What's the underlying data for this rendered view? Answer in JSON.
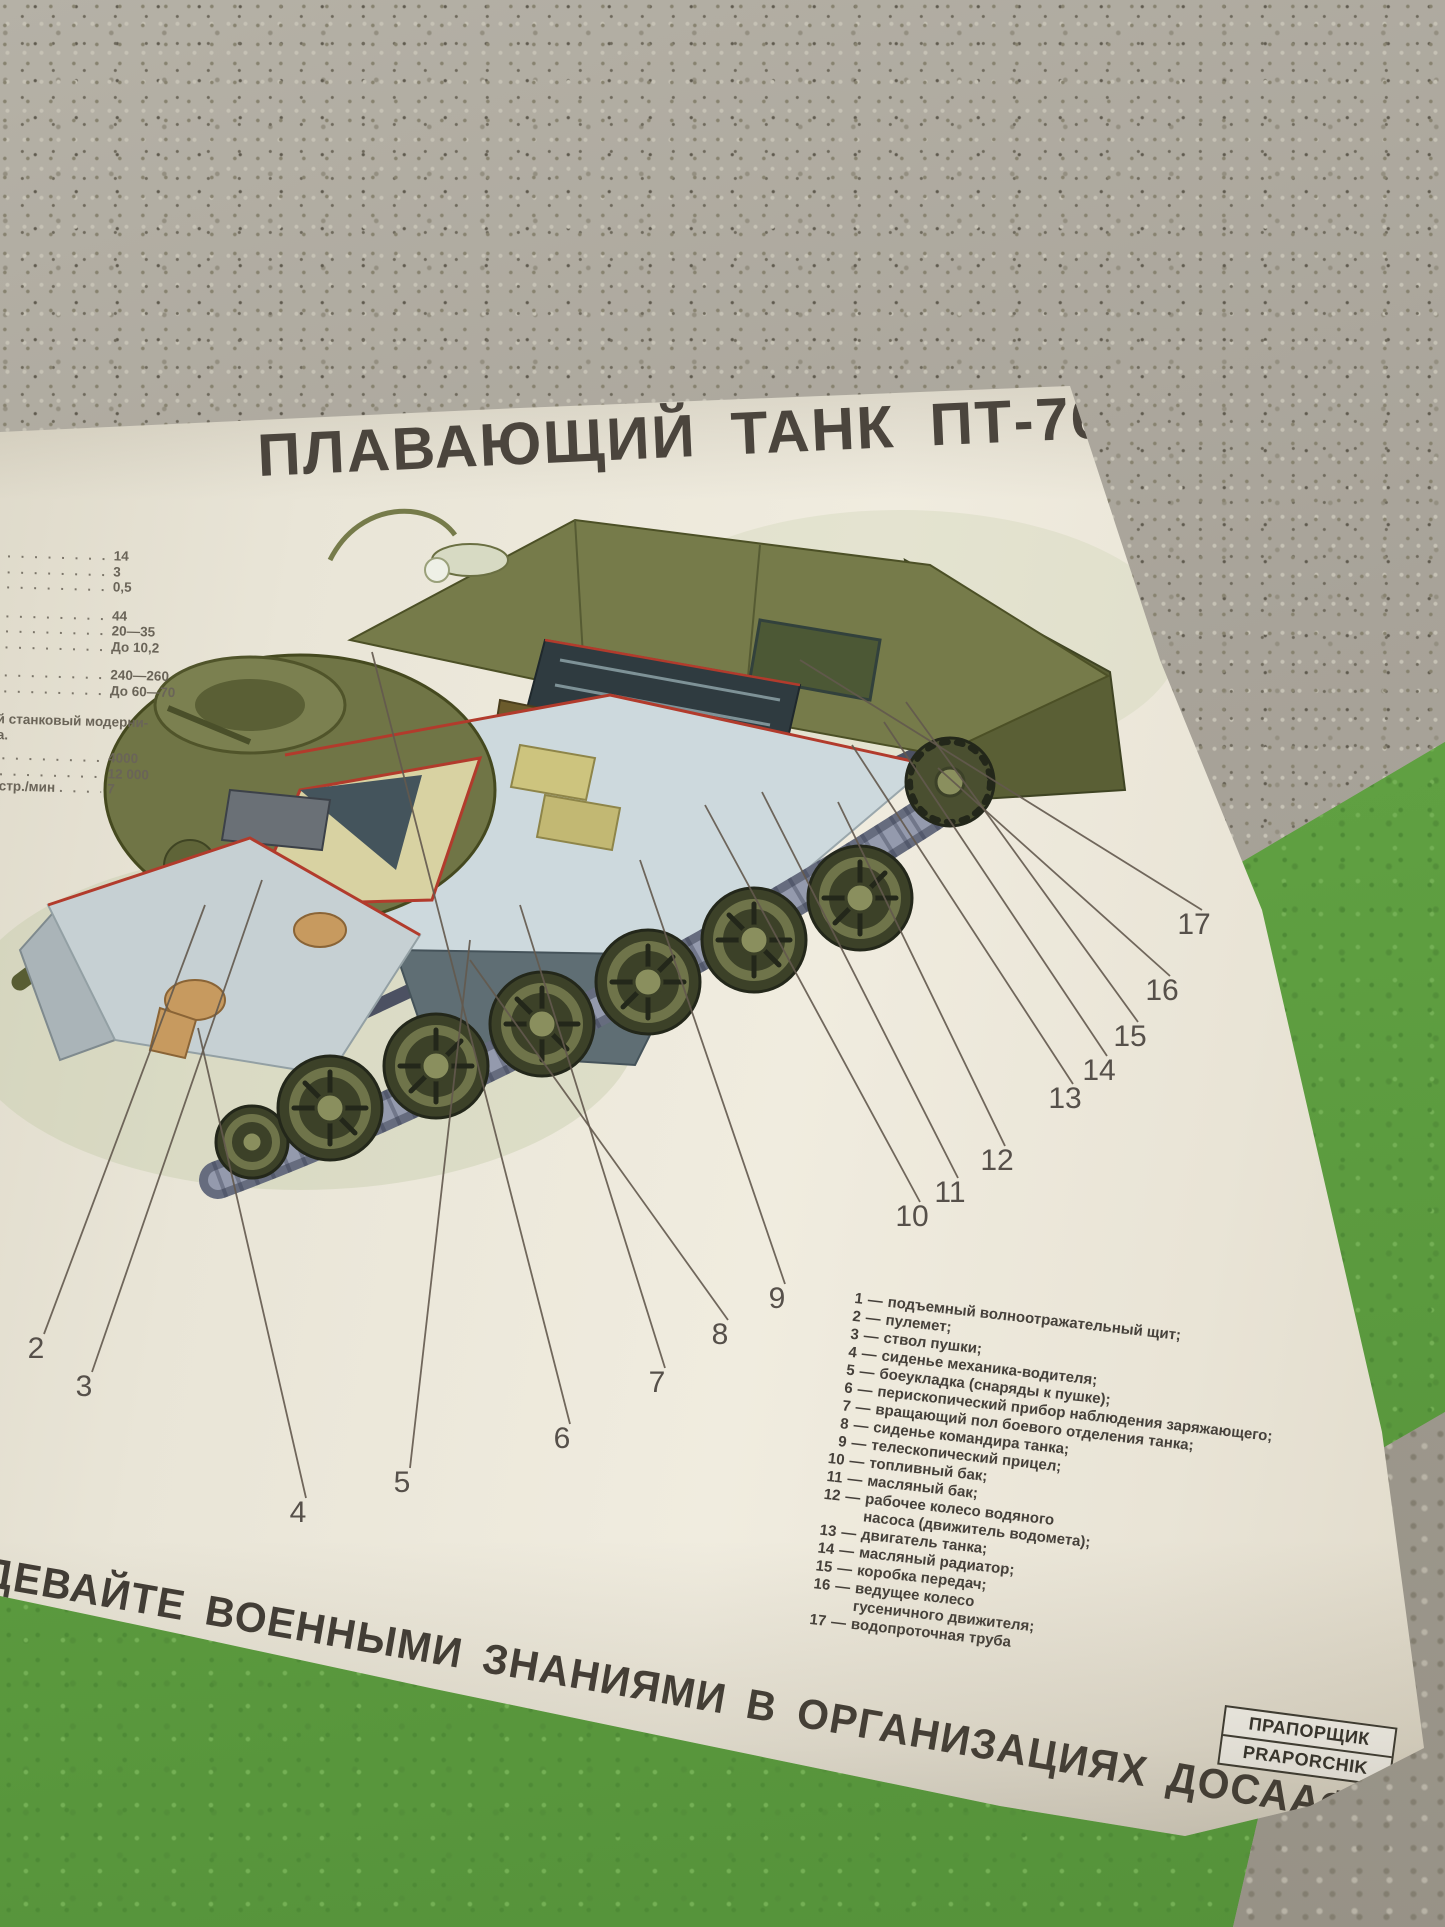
{
  "scene": {
    "wall_top_color": "#aba69c",
    "wall_bottom_color": "#5f9f41",
    "paper_color": "#eae6d9"
  },
  "poster": {
    "title": "ПЛАВАЮЩИЙ ТАНК ПТ-76",
    "title_color": "#4b453d",
    "accent_red": "#b23b2c",
    "tank_olive": "#707546",
    "specs": {
      "entries": [
        {
          "type": "row",
          "fragment": "",
          "value": "14",
          "gap": false
        },
        {
          "type": "row",
          "fragment": "",
          "value": "3",
          "gap": false
        },
        {
          "type": "row",
          "fragment": "",
          "value": "0,5",
          "gap": false
        },
        {
          "type": "row",
          "fragment": "",
          "value": "44",
          "gap": true
        },
        {
          "type": "row",
          "fragment": "",
          "value": "20—35",
          "gap": false
        },
        {
          "type": "row",
          "fragment": "",
          "value": "До 10,2",
          "gap": false
        },
        {
          "type": "row",
          "fragment": "",
          "value": "240—260",
          "gap": true
        },
        {
          "type": "row",
          "fragment": "",
          "value": "До 60—70",
          "gap": false
        },
        {
          "type": "note",
          "lines": [
            "ей станковый модерни-",
            "ва."
          ]
        },
        {
          "type": "row",
          "fragment": "",
          "value": "4000",
          "gap": false
        },
        {
          "type": "row",
          "fragment": "а",
          "value": "12 000",
          "gap": false
        },
        {
          "type": "row",
          "fragment": "ыстр./мин",
          "value": "7",
          "gap": false
        }
      ]
    },
    "legend": {
      "items": [
        {
          "num": "1",
          "text": "подъемный волноотражательный щит;",
          "text2": ""
        },
        {
          "num": "2",
          "text": "пулемет;",
          "text2": ""
        },
        {
          "num": "3",
          "text": "ствол пушки;",
          "text2": ""
        },
        {
          "num": "4",
          "text": "сиденье механика-водителя;",
          "text2": ""
        },
        {
          "num": "5",
          "text": "боеукладка (снаряды к пушке);",
          "text2": ""
        },
        {
          "num": "6",
          "text": "перископический прибор наблюдения заряжающего;",
          "text2": ""
        },
        {
          "num": "7",
          "text": "вращающий пол боевого отделения танка;",
          "text2": ""
        },
        {
          "num": "8",
          "text": "сиденье командира танка;",
          "text2": ""
        },
        {
          "num": "9",
          "text": "телескопический прицел;",
          "text2": ""
        },
        {
          "num": "10",
          "text": "топливный бак;",
          "text2": ""
        },
        {
          "num": "11",
          "text": "масляный бак;",
          "text2": ""
        },
        {
          "num": "12",
          "text": "рабочее колесо водяного",
          "text2": "насоса (движитель водомета);"
        },
        {
          "num": "13",
          "text": "двигатель танка;",
          "text2": ""
        },
        {
          "num": "14",
          "text": "масляный радиатор;",
          "text2": ""
        },
        {
          "num": "15",
          "text": "коробка передач;",
          "text2": ""
        },
        {
          "num": "16",
          "text": "ведущее колесо",
          "text2": "гусеничного движителя;"
        },
        {
          "num": "17",
          "text": "водопроточная труба",
          "text2": ""
        }
      ]
    },
    "callout_numbers": [
      "2",
      "3",
      "4",
      "5",
      "6",
      "7",
      "8",
      "9",
      "10",
      "11",
      "12",
      "13",
      "14",
      "15",
      "16",
      "17"
    ],
    "slogan": "ДЕВАЙТЕ ВОЕННЫМИ ЗНАНИЯМИ В ОРГАНИЗАЦИЯХ ДОСААФ.",
    "stamp": {
      "line1": "ПРАПОРЩИК",
      "line2": "PRAPORCHIK"
    }
  }
}
